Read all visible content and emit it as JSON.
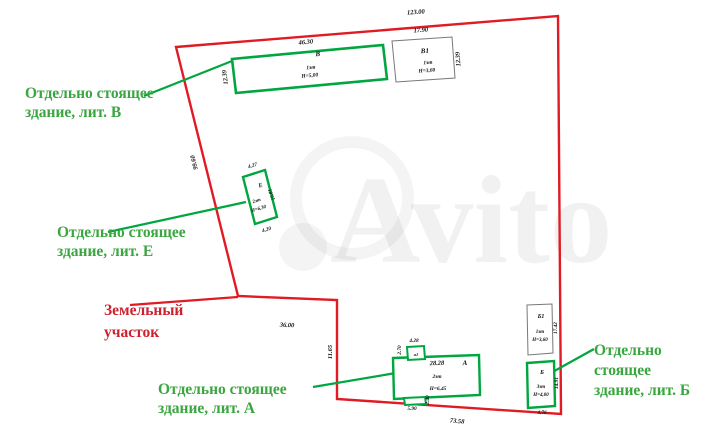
{
  "watermark": {
    "text": "Avito"
  },
  "colors": {
    "boundary_red": "#e01b24",
    "building_green": "#00a63f",
    "label_green": "#3aa63f",
    "label_red": "#cf2030",
    "outline_gray": "#777777",
    "dim_text": "#111111"
  },
  "labels": {
    "v": {
      "l1": "Отдельно стоящее",
      "l2": "здание, лит. В"
    },
    "e": {
      "l1": "Отдельно стоящее",
      "l2": "здание, лит. Е"
    },
    "a": {
      "l1": "Отдельно стоящее",
      "l2": "здание, лит. А"
    },
    "b": {
      "l1": "Отдельно",
      "l2": "стоящее",
      "l3": "здание, лит. Б"
    },
    "plot": {
      "l1": "Земельный",
      "l2": "участок"
    }
  },
  "dims": {
    "top": "123.00",
    "left": "99.60",
    "bottom": "73.58",
    "mid_h": "36.00",
    "mid_v": "11.65"
  },
  "b": {
    "v": {
      "name": "В",
      "floors": "1эт",
      "height": "Н=5,00",
      "w": "46.30",
      "s": "12.39"
    },
    "v1": {
      "name": "В1",
      "floors": "1эт",
      "height": "Н=3,60",
      "w": "17.90",
      "s": "12.39"
    },
    "e": {
      "name": "Е",
      "floors": "2эт",
      "height": "Н=6,30",
      "w": "4.27",
      "s": "10.81",
      "bt": "4.20"
    },
    "a": {
      "name": "А",
      "floors": "2эт",
      "height": "Н=6,45",
      "w": "28.28",
      "pt_w": "4.28",
      "pt_h": "2.70",
      "pt_label": "а1",
      "pb_w": "5.90",
      "pb_h": "2.40"
    },
    "b": {
      "name": "Б",
      "floors": "3эт",
      "height": "Н=4,00",
      "w": "4.76",
      "s": "14.91"
    },
    "b1": {
      "name": "Б1",
      "floors": "1эт",
      "height": "Н=3,60",
      "s": "17.42"
    }
  }
}
